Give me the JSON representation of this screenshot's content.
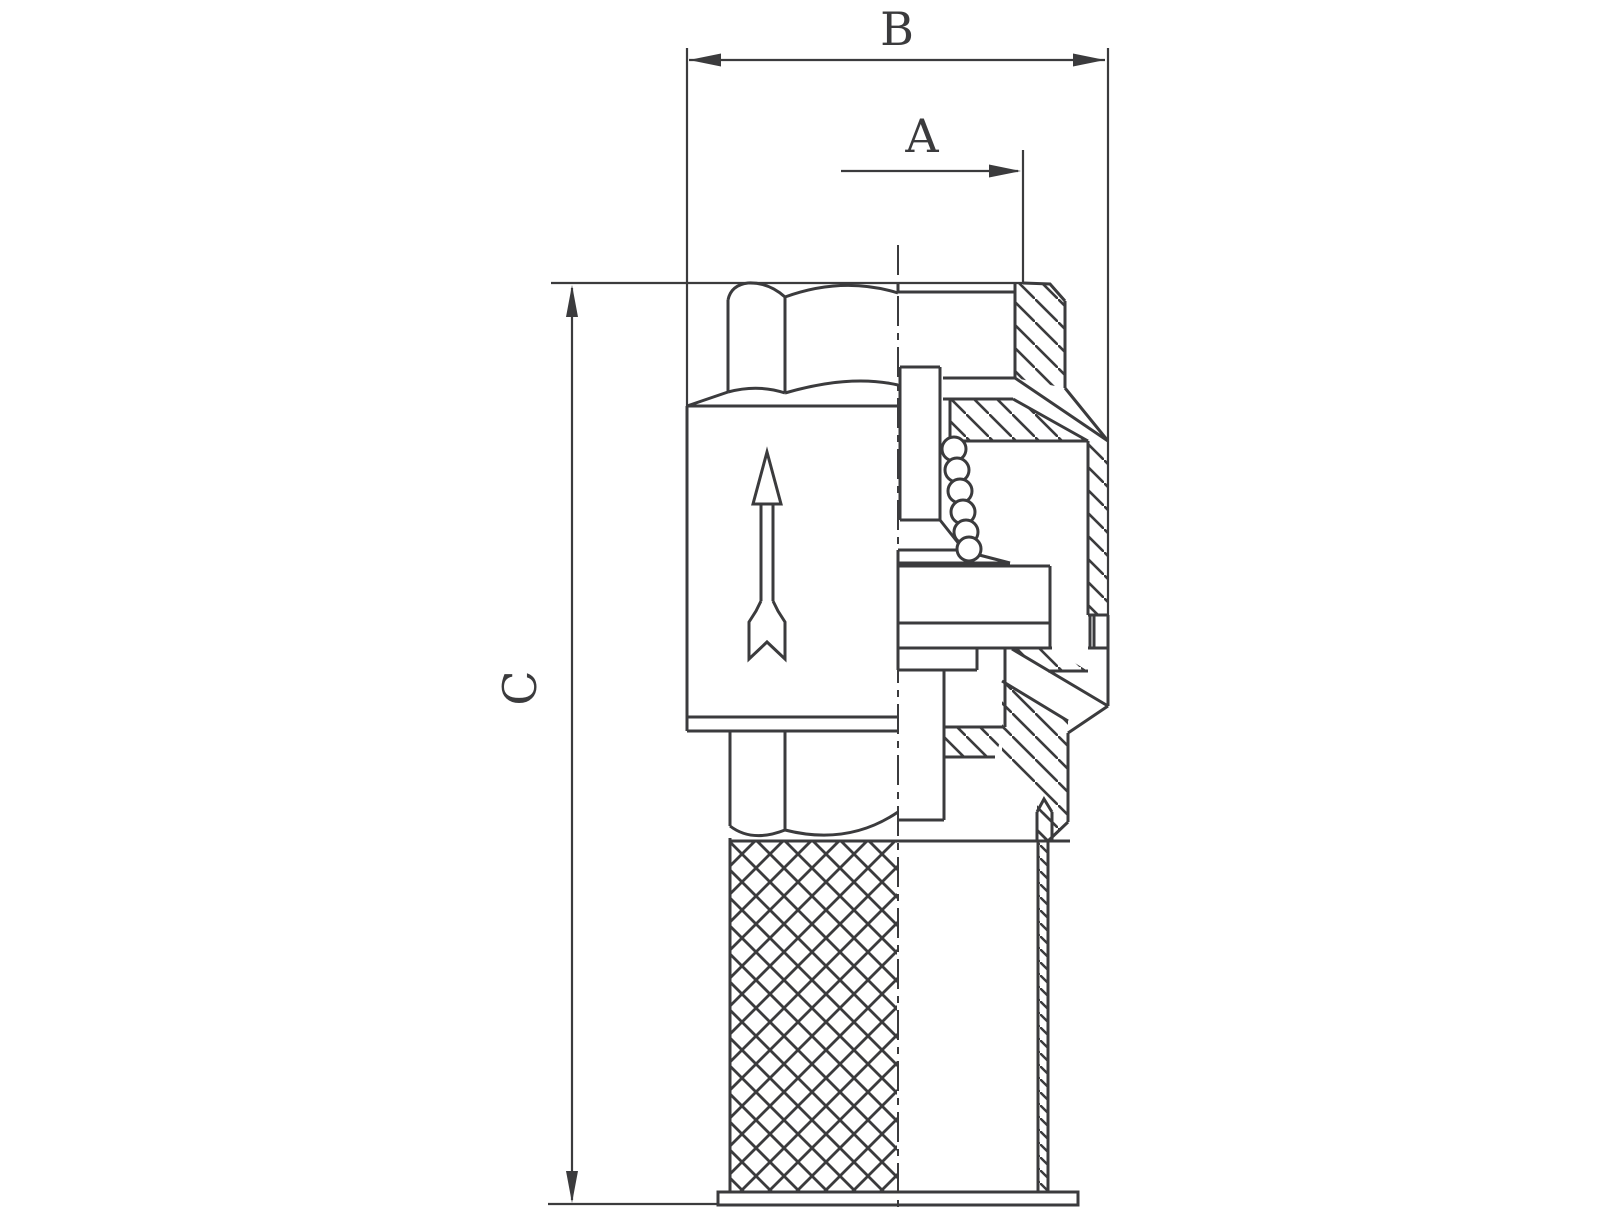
{
  "drawing": {
    "type": "technical-section-drawing",
    "subject": "check-valve-with-strainer-cross-section",
    "labels": {
      "dim_a": "A",
      "dim_b": "B",
      "dim_c": "C"
    },
    "icons": {
      "flow_direction": "up-arrow"
    },
    "colors": {
      "line": "#3b3b3d",
      "background": "#ffffff"
    }
  }
}
